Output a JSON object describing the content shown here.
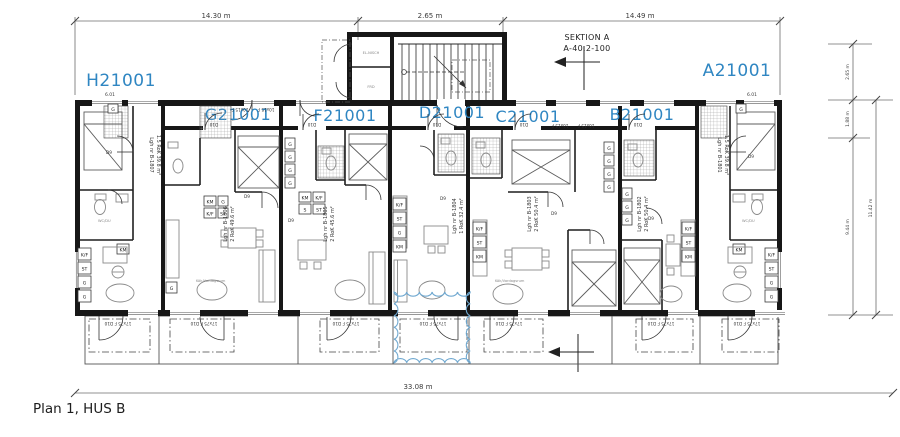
{
  "drawing_title": "Plan 1, HUS B",
  "section_marker": {
    "name": "SEKTION A",
    "ref": "A-40.2-100"
  },
  "apartments": [
    {
      "code": "H21001",
      "lgh": "Lgh nr B-1807",
      "size": "1.5 RoK 39.8 m²"
    },
    {
      "code": "G21001",
      "lgh": "Lgh nr B-1806",
      "size": "2 RoK 49.6 m²"
    },
    {
      "code": "F21001",
      "lgh": "Lgh nr B-1805",
      "size": "2 RoK 45.6 m²"
    },
    {
      "code": "D21001",
      "lgh": "Lgh nr B-1804",
      "size": "1 RoK 32.4 m²"
    },
    {
      "code": "C21001",
      "lgh": "Lgh nr B-1803",
      "size": "2 RoK 50.4 m²"
    },
    {
      "code": "B21001",
      "lgh": "Lgh nr B-1802",
      "size": "2 RoK 50.4 m²"
    },
    {
      "code": "A21001",
      "lgh": "Lgh nr B-1801",
      "size": "1.5 RoK 39.8 m²"
    }
  ],
  "dimensions": {
    "top_left": "14.30 m",
    "top_mid": "2.65 m",
    "top_right": "14.49 m",
    "right_1": "2.65 m",
    "right_2": "1.88 m",
    "right_3": "9.44 m",
    "right_4": "11.42 m",
    "bottom": "33.08 m"
  },
  "fixtures": {
    "g": "G",
    "km": "KM",
    "st": "ST",
    "kf": "K/F",
    "s": "S",
    "d9": "D9",
    "d10": "D10",
    "win": "10x15 F",
    "bdoor": "17x75 F  D10",
    "mark": "6.01",
    "stair_room_top": "EL-NISCH",
    "stair_room_bottom": "FRD",
    "wc": "WC/DU",
    "living": "Kök/Vardagsrum"
  },
  "colors": {
    "unit_label": "#2f86c2",
    "revision_cloud": "#6fa8d0",
    "wall": "#171717"
  }
}
